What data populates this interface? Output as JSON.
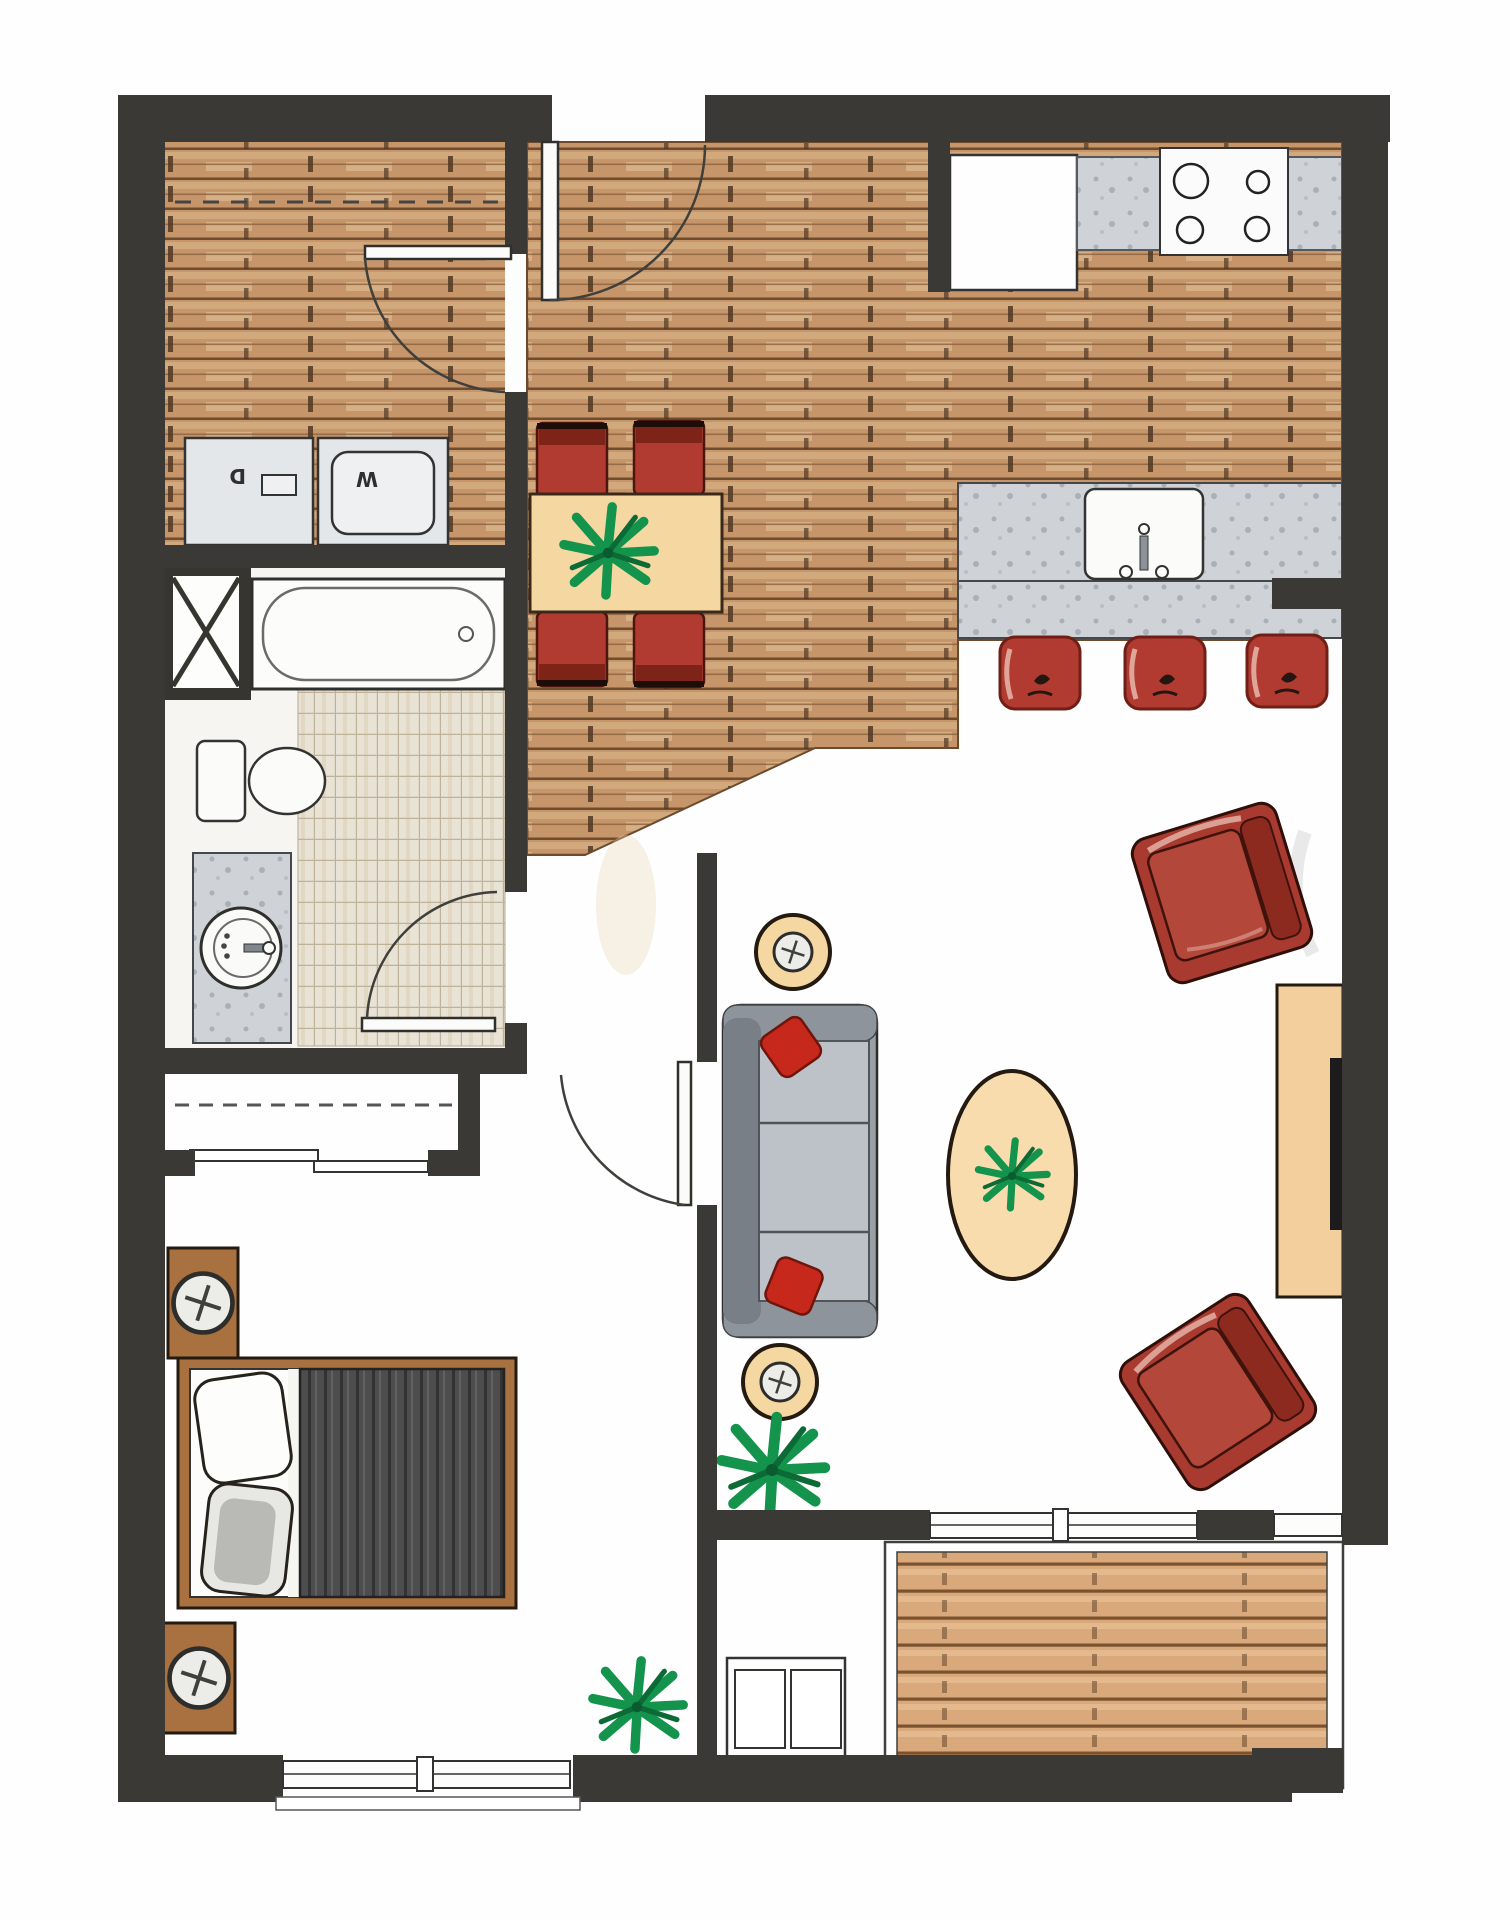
{
  "labels": {
    "dryer": "D",
    "washer": "W"
  },
  "palette": {
    "wall": "#3a3936",
    "wood_floor": "#c6966a",
    "wood_plank_line": "#6e4c2f",
    "deck_wood": "#d9a97b",
    "counter_gray": "#cfd3d7",
    "tile": "#e9e3d5",
    "red_upholstery": "#b23b31",
    "armchair_red": "#a93a30",
    "table_tan": "#f5d7a2",
    "rug_tan": "#f8dcae",
    "console_tan": "#f3cf9e",
    "wood_brown": "#a9713f",
    "sofa_gray": "#9aa0a6",
    "duvet_gray": "#4d4d4d",
    "plant_green": "#14934c",
    "fixture_white": "#fbfbf9"
  }
}
